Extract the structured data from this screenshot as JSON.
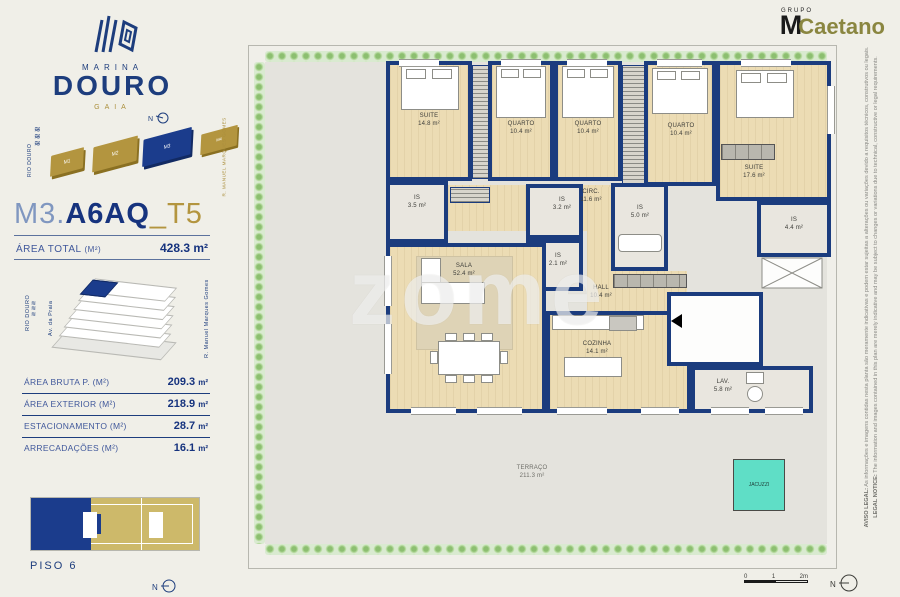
{
  "logo": {
    "marina": "MARINA",
    "douro": "DOURO",
    "gaia": "GAIA"
  },
  "grupo": {
    "small": "GRUPO",
    "m": "M",
    "caetano": "Caetano"
  },
  "site": {
    "river": "RIO DOURO",
    "street": "R. MANUEL MARQUES GOMES",
    "north": "N",
    "blocks": [
      "M1",
      "M2",
      "M3",
      "M4"
    ]
  },
  "unit": {
    "prefix": "M3.",
    "code": "A6AQ",
    "suffix": "_T5",
    "area_label": "ÁREA TOTAL",
    "area_unit": "(M²)",
    "area_value": "428.3 m²"
  },
  "building_labels": {
    "river": "RIO DOURO",
    "avenue": "Av. da Praia",
    "street": "R. Manuel Marques Gomes"
  },
  "areas": [
    {
      "label": "ÁREA BRUTA P.  (M²)",
      "value": "209.3",
      "unit": "m²"
    },
    {
      "label": "ÁREA EXTERIOR (M²)",
      "value": "218.9",
      "unit": "m²"
    },
    {
      "label": "ESTACIONAMENTO (M²)",
      "value": "28.7",
      "unit": "m²"
    },
    {
      "label": "ARRECADAÇÕES (M²)",
      "value": "16.1",
      "unit": "m²"
    }
  ],
  "floor": {
    "label": "PISO 6",
    "north": "N"
  },
  "plan": {
    "watermark": "zome",
    "jacuzzi": "JACUZZI",
    "north": "N",
    "scale": [
      "0",
      "1",
      "2m"
    ],
    "rooms": [
      {
        "name": "SUITE",
        "area": "14.8 m²"
      },
      {
        "name": "QUARTO",
        "area": "10.4 m²"
      },
      {
        "name": "QUARTO",
        "area": "10.4 m²"
      },
      {
        "name": "QUARTO",
        "area": "10.4 m²"
      },
      {
        "name": "SUITE",
        "area": "17.6 m²"
      },
      {
        "name": "CIRC.",
        "area": "11.6 m²"
      },
      {
        "name": "IS",
        "area": "3.5 m²"
      },
      {
        "name": "IS",
        "area": "3.2 m²"
      },
      {
        "name": "IS",
        "area": "2.1 m²"
      },
      {
        "name": "IS",
        "area": "5.0 m²"
      },
      {
        "name": "IS",
        "area": "4.4 m²"
      },
      {
        "name": "SALA",
        "area": "52.4 m²"
      },
      {
        "name": "HALL",
        "area": "10.4 m²"
      },
      {
        "name": "COZINHA",
        "area": "14.1 m²"
      },
      {
        "name": "LAV.",
        "area": "5.8 m²"
      },
      {
        "name": "TERRAÇO",
        "area": "211.3 m²"
      }
    ]
  },
  "legal": {
    "pt_label": "AVISO LEGAL:",
    "pt_text": "As informações e imagens contidas nesta planta são meramente indicativas e podem estar sujeitas a alterações ou variações devido a requisitos técnicos, construtivos ou legais.",
    "en_label": "LEGAL NOTICE:",
    "en_text": "The information and images contained in this plan are merely indicative and may be subject to changes or variations due to technical, constructive or legal requirements."
  },
  "colors": {
    "navy": "#1d3d7d",
    "gold": "#b3953f",
    "wall": "#1b3c7e",
    "jacuzzi": "#5fdec6",
    "wood": "#ecdcb4",
    "terrace": "#e4e3dd"
  }
}
